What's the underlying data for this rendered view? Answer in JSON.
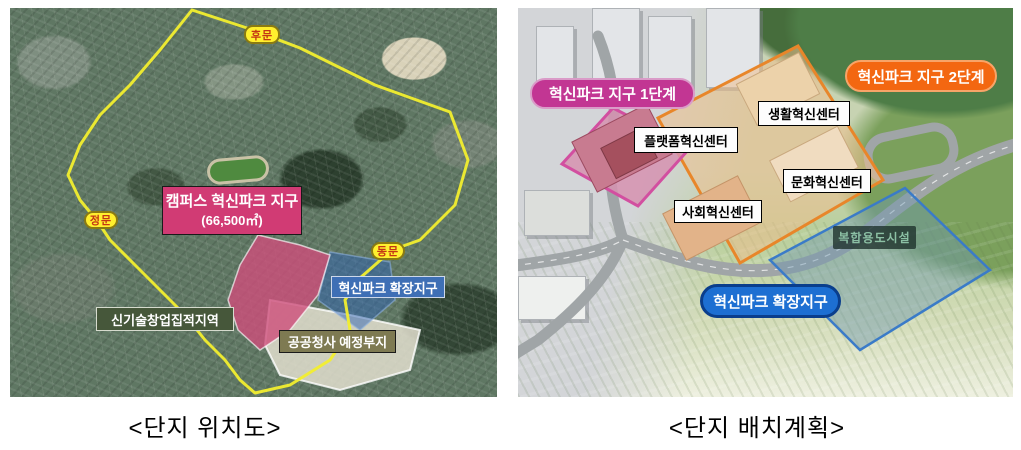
{
  "colors": {
    "district-pink": "#d13b74",
    "expansion-blue": "#3e6fb5",
    "newtech-green": "#46573a",
    "public-olive": "#7e7a52",
    "gate-yellow": "#ffef2e",
    "gate-text": "#c33614",
    "phase1-magenta": "#c23693",
    "phase2-orange": "#f36711",
    "expansion-pill-blue": "#1d6fd2"
  },
  "left_map": {
    "caption": "<단지 위치도>",
    "gates": {
      "rear": "후문",
      "main": "정문",
      "east": "동문"
    },
    "district_box": {
      "title": "캠퍼스 혁신파크 지구",
      "area": "(66,500㎡)"
    },
    "labels": {
      "expansion": "혁신파크 확장지구",
      "newtech": "신기술창업집적지역",
      "public_site": "공공청사 예정부지"
    }
  },
  "right_map": {
    "caption": "<단지 배치계획>",
    "phase1": "혁신파크 지구 1단계",
    "phase2": "혁신파크 지구 2단계",
    "expansion": "혁신파크 확장지구",
    "mixed_use": "복합용도시설",
    "centers": {
      "life": "생활혁신센터",
      "platform": "플랫폼혁신센터",
      "culture": "문화혁신센터",
      "social": "사회혁신센터"
    }
  }
}
